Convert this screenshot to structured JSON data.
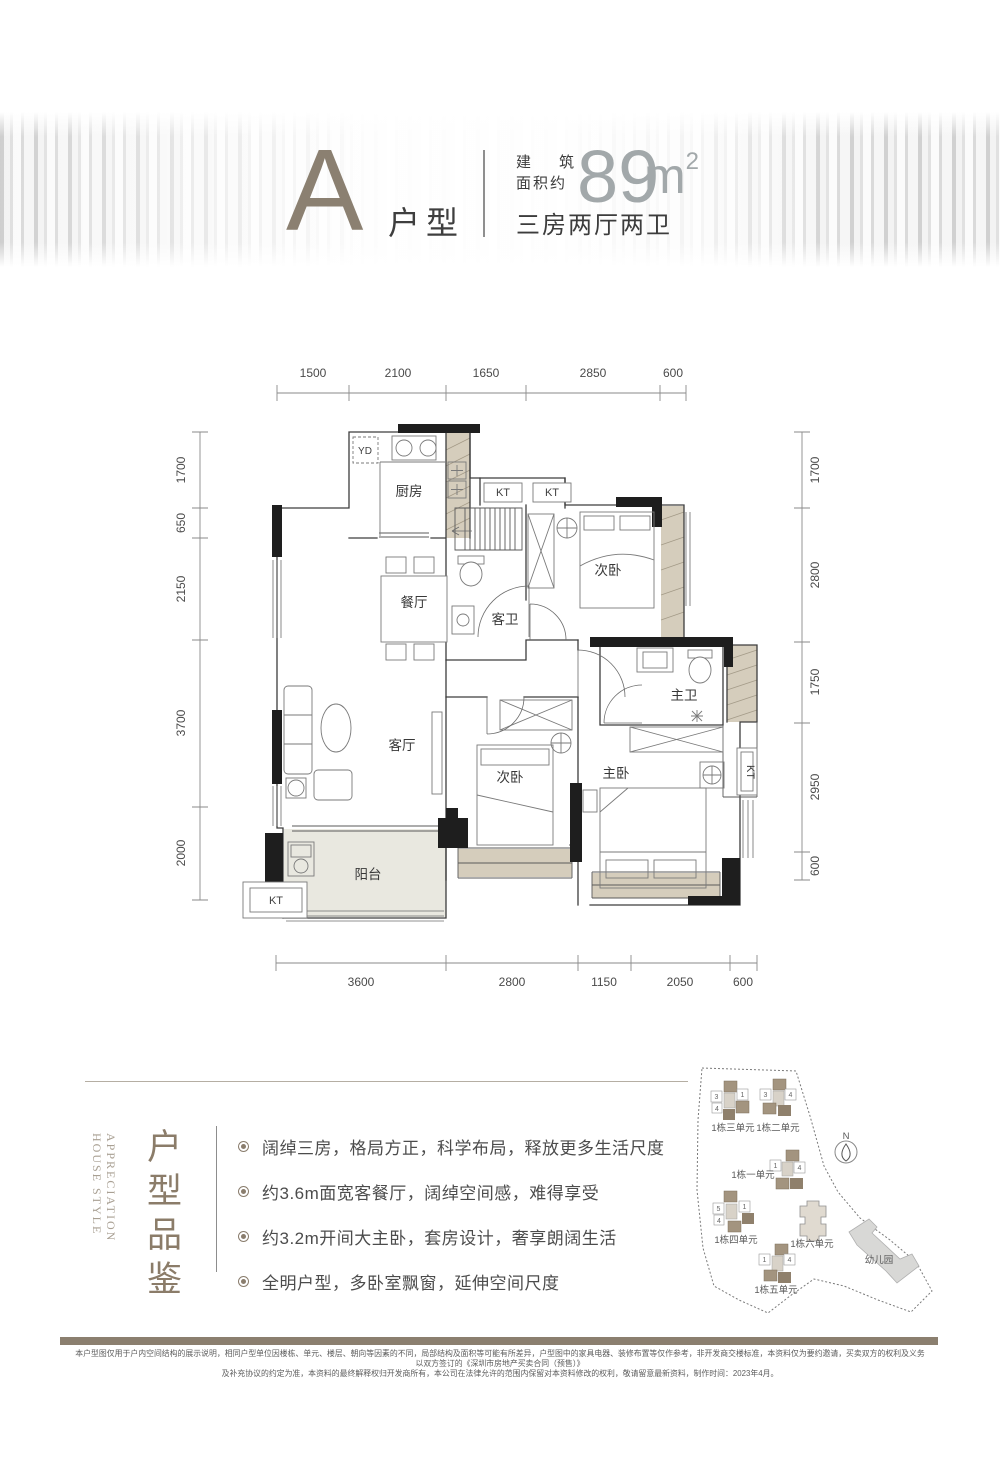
{
  "header": {
    "type_letter": "A",
    "type_suffix": "户型",
    "area_label_l1": "建筑",
    "area_label_l2": "面积约",
    "area_value": "89",
    "area_unit": "m",
    "area_exp": "2",
    "spec": "三房两厅两卫"
  },
  "plan": {
    "rooms": {
      "kitchen": "厨房",
      "dining": "餐厅",
      "guest_bath": "客卫",
      "bedroom_top": "次卧",
      "living": "客厅",
      "bedroom_mid": "次卧",
      "master": "主卧",
      "master_bath": "主卫",
      "balcony": "阳台"
    },
    "marks": {
      "kt": "KT",
      "yd": "YD"
    },
    "dims": {
      "top": [
        "1500",
        "2100",
        "1650",
        "2850",
        "600"
      ],
      "left": [
        "1700",
        "650",
        "2150",
        "3700",
        "2000"
      ],
      "right": [
        "1700",
        "2800",
        "1750",
        "2950",
        "600"
      ],
      "bottom": [
        "3600",
        "2800",
        "1150",
        "2050",
        "600"
      ]
    }
  },
  "section": {
    "title_cn": "户型品鉴",
    "title_en": [
      "HOUSE STYLE",
      "APPRECIATION"
    ],
    "bullets": [
      "阔绰三房，格局方正，科学布局，释放更多生活尺度",
      "约3.6m面宽客餐厅，阔绰空间感，难得享受",
      "约3.2m开间大主卧，套房设计，奢享朗阔生活",
      "全明户型，多卧室飘窗，延伸空间尺度"
    ]
  },
  "site": {
    "compass": "N",
    "buildings": [
      {
        "name": "1栋三单元",
        "tags": [
          "3",
          "1",
          "4"
        ]
      },
      {
        "name": "1栋二单元",
        "tags": [
          "3",
          "4"
        ]
      },
      {
        "name": "1栋一单元",
        "tags": [
          "1",
          "4"
        ]
      },
      {
        "name": "1栋四单元",
        "tags": [
          "5",
          "1",
          "4"
        ]
      },
      {
        "name": "1栋六单元",
        "tags": []
      },
      {
        "name": "1栋五单元",
        "tags": [
          "1",
          "4"
        ]
      },
      {
        "name": "幼儿园",
        "tags": []
      }
    ]
  },
  "colors": {
    "accent": "#8b7c69",
    "dark": "#3f3f3f",
    "beige": "#d5cdbc",
    "wall": "#1e1e1e"
  },
  "footer": {
    "line1": "本户型图仅用于户内空间结构的展示说明，相同户型单位因楼栋、单元、楼层、朝向等因素的不同，局部结构及面积等可能有所差异，户型图中的家具电器、装修布置等仅作参考，非开发商交楼标准，本资料仅为要约邀请，买卖双方的权利及义务以双方签订的《深圳市房地产买卖合同（预售）》",
    "line2": "及补充协议的约定为准，本资料的最终解释权归开发商所有，本公司在法律允许的范围内保留对本资料修改的权利，敬请留意最新资料，制作时间：2023年4月。"
  }
}
